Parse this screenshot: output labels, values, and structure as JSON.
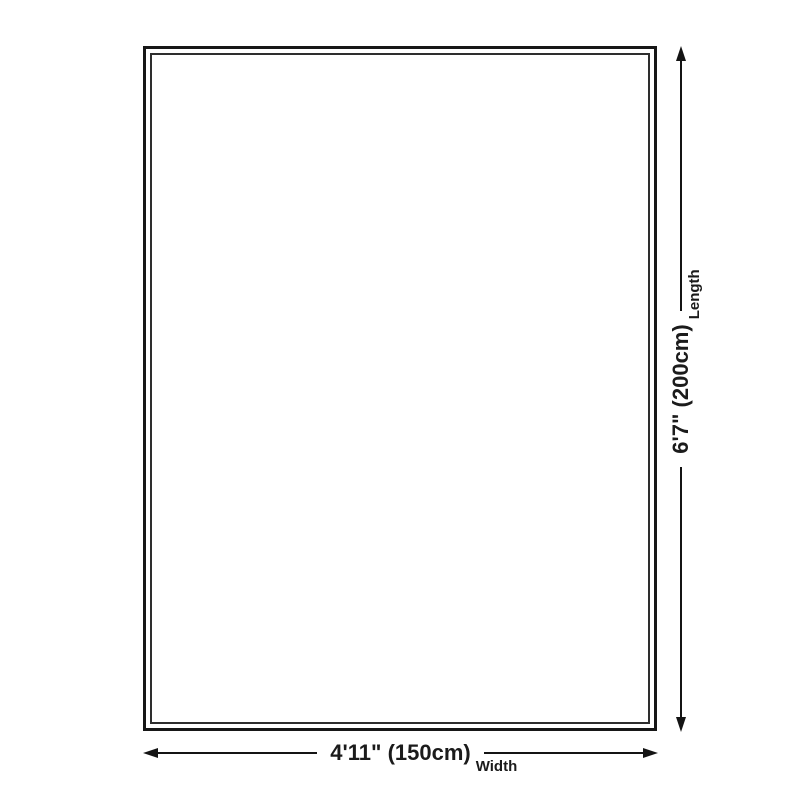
{
  "diagram": {
    "title": "product-size-diagram",
    "colors": {
      "ink": "#141414",
      "outline_outer": "#171717",
      "outline_inner": "#2e2e2e",
      "background": "#ffffff"
    },
    "dimensions": {
      "length": {
        "value": "6'7\" (200cm)",
        "label": "Length"
      },
      "width": {
        "value": "4'11\" (150cm)",
        "label": "Width"
      }
    }
  }
}
